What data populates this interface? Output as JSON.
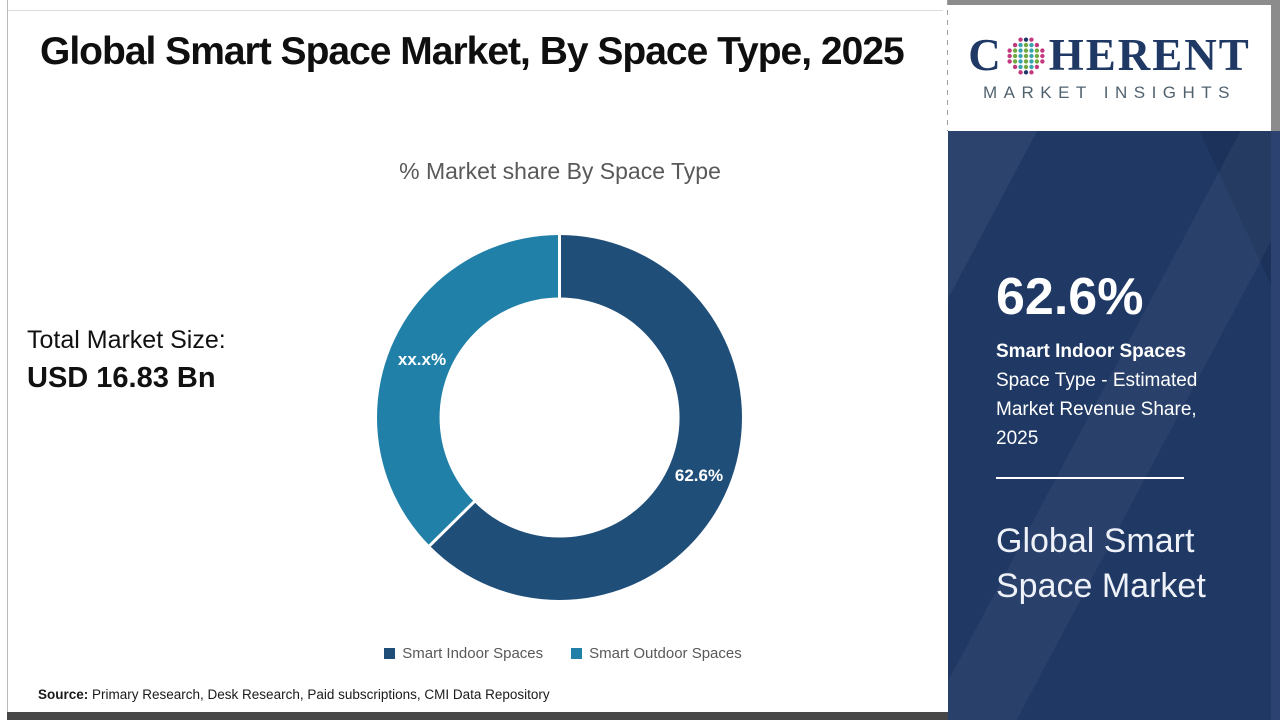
{
  "header": {
    "title": "Global Smart Space Market, By Space Type, 2025"
  },
  "logo": {
    "brand_left": "C",
    "brand_right": "HERENT",
    "brand_sub": "MARKET INSIGHTS",
    "globe_icon": "dotted-globe"
  },
  "left_panel": {
    "total_label": "Total Market Size:",
    "total_value": "USD 16.83 Bn"
  },
  "chart_data": {
    "type": "pie",
    "subtype": "donut",
    "title": "% Market share By Space Type",
    "categories": [
      "Smart Indoor Spaces",
      "Smart Outdoor Spaces"
    ],
    "values": [
      62.6,
      37.4
    ],
    "slice_labels": [
      "62.6%",
      "xx.x%"
    ],
    "colors": [
      "#1F4E79",
      "#2080A8"
    ],
    "start_angle_deg": 0,
    "direction": "clockwise",
    "donut_hole_ratio": 0.66,
    "legend_position": "bottom",
    "slice_label_color": "#FFFFFF"
  },
  "sidebar": {
    "stat_value": "62.6%",
    "stat_title": "Smart Indoor Spaces",
    "stat_desc": "Space Type - Estimated Market Revenue Share, 2025",
    "footer_title": "Global Smart Space Market",
    "background_color": "#1F3864"
  },
  "footer": {
    "source_label": "Source:",
    "source_text": " Primary Research, Desk Research, Paid subscriptions, CMI Data Repository"
  },
  "colors": {
    "indoor_slice": "#1F4E79",
    "outdoor_slice": "#2080A8",
    "sidebar_navy": "#1F3864",
    "logo_navy": "#1F3864",
    "muted_text": "#595959"
  }
}
